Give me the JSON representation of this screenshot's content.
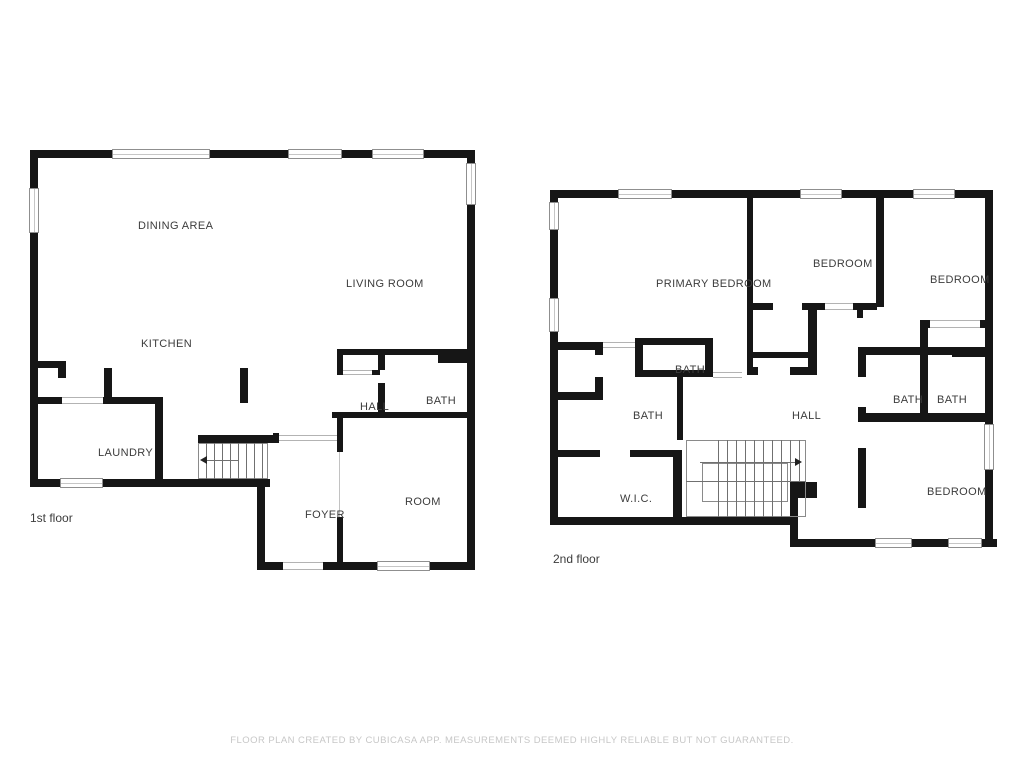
{
  "title": "Floor plan",
  "colors": {
    "wall": "#161616",
    "label": "#3c3c3c",
    "footer": "#c7c7c7",
    "window_border": "#8f8f8f"
  },
  "footer": {
    "text": "FLOOR PLAN CREATED BY CUBICASA APP. MEASUREMENTS DEEMED HIGHLY RELIABLE BUT NOT GUARANTEED."
  },
  "floors": [
    {
      "label": "1st floor",
      "label_pos": [
        30,
        511
      ],
      "rooms": [
        {
          "name": "DINING AREA",
          "x": 138,
          "y": 220
        },
        {
          "name": "LIVING ROOM",
          "x": 346,
          "y": 278
        },
        {
          "name": "KITCHEN",
          "x": 141,
          "y": 338
        },
        {
          "name": "HALL",
          "x": 360,
          "y": 401
        },
        {
          "name": "BATH",
          "x": 426,
          "y": 395
        },
        {
          "name": "LAUNDRY",
          "x": 98,
          "y": 447
        },
        {
          "name": "FOYER",
          "x": 305,
          "y": 509
        },
        {
          "name": "ROOM",
          "x": 405,
          "y": 496
        }
      ],
      "walls": [
        [
          30,
          150,
          445,
          8
        ],
        [
          30,
          150,
          8,
          337
        ],
        [
          467,
          150,
          8,
          420
        ],
        [
          30,
          479,
          240,
          8
        ],
        [
          257,
          479,
          8,
          91
        ],
        [
          257,
          562,
          28,
          8
        ],
        [
          321,
          562,
          154,
          8
        ],
        [
          30,
          397,
          133,
          7
        ],
        [
          155,
          397,
          8,
          90
        ],
        [
          30,
          361,
          36,
          7
        ],
        [
          58,
          361,
          8,
          17
        ],
        [
          104,
          368,
          8,
          36
        ],
        [
          240,
          368,
          8,
          35
        ],
        [
          198,
          435,
          77,
          8
        ],
        [
          273,
          433,
          6,
          10
        ],
        [
          337,
          349,
          138,
          6
        ],
        [
          438,
          353,
          37,
          10
        ],
        [
          337,
          349,
          6,
          26
        ],
        [
          372,
          370,
          8,
          5
        ],
        [
          378,
          349,
          7,
          21
        ],
        [
          378,
          383,
          7,
          29
        ],
        [
          332,
          412,
          141,
          6
        ],
        [
          337,
          412,
          6,
          40
        ],
        [
          337,
          517,
          6,
          45
        ]
      ],
      "windows": [
        [
          112,
          149,
          98,
          10
        ],
        [
          288,
          149,
          54,
          10
        ],
        [
          372,
          149,
          52,
          10
        ],
        [
          29,
          188,
          10,
          45
        ],
        [
          466,
          163,
          10,
          42
        ],
        [
          60,
          478,
          43,
          10
        ],
        [
          377,
          561,
          53,
          10
        ]
      ],
      "openings": [
        [
          62,
          397,
          41,
          7
        ],
        [
          343,
          370,
          29,
          5
        ],
        [
          279,
          435,
          58,
          6
        ],
        [
          283,
          562,
          40,
          8
        ]
      ],
      "lines": [
        [
          339,
          452,
          339,
          517
        ]
      ],
      "stairs": {
        "rects": [
          [
            198,
            443,
            70,
            36
          ]
        ],
        "lines": [
          [
            206,
            443,
            206,
            479
          ],
          [
            214,
            443,
            214,
            479
          ],
          [
            222,
            443,
            222,
            479
          ],
          [
            230,
            443,
            230,
            479
          ],
          [
            238,
            443,
            238,
            479
          ],
          [
            246,
            443,
            246,
            479
          ],
          [
            254,
            443,
            254,
            479
          ],
          [
            262,
            443,
            262,
            479
          ]
        ],
        "arrow": {
          "tail": [
            238,
            460
          ],
          "tip": [
            201,
            460
          ]
        }
      }
    },
    {
      "label": "2nd floor",
      "label_pos": [
        553,
        552
      ],
      "rooms": [
        {
          "name": "PRIMARY BEDROOM",
          "x": 656,
          "y": 278
        },
        {
          "name": "BEDROOM",
          "x": 813,
          "y": 258
        },
        {
          "name": "BEDROOM",
          "x": 930,
          "y": 274
        },
        {
          "name": "BATH",
          "x": 675,
          "y": 364
        },
        {
          "name": "BATH",
          "x": 633,
          "y": 410
        },
        {
          "name": "HALL",
          "x": 792,
          "y": 410
        },
        {
          "name": "BATH",
          "x": 893,
          "y": 394
        },
        {
          "name": "BATH",
          "x": 937,
          "y": 394
        },
        {
          "name": "BEDROOM",
          "x": 927,
          "y": 486
        },
        {
          "name": "W.I.C.",
          "x": 620,
          "y": 493
        }
      ],
      "walls": [
        [
          550,
          190,
          443,
          8
        ],
        [
          550,
          190,
          8,
          335
        ],
        [
          985,
          190,
          8,
          357
        ],
        [
          550,
          517,
          248,
          8
        ],
        [
          790,
          539,
          207,
          8
        ],
        [
          790,
          482,
          8,
          65
        ],
        [
          790,
          482,
          27,
          16
        ],
        [
          747,
          192,
          6,
          181
        ],
        [
          876,
          192,
          8,
          115
        ],
        [
          753,
          303,
          20,
          7
        ],
        [
          802,
          303,
          23,
          7
        ],
        [
          853,
          303,
          24,
          7
        ],
        [
          857,
          310,
          6,
          8
        ],
        [
          747,
          352,
          68,
          6
        ],
        [
          747,
          367,
          11,
          8
        ],
        [
          790,
          367,
          27,
          8
        ],
        [
          808,
          303,
          9,
          72
        ],
        [
          635,
          338,
          78,
          7
        ],
        [
          635,
          338,
          8,
          39
        ],
        [
          705,
          338,
          8,
          39
        ],
        [
          635,
          370,
          78,
          7
        ],
        [
          558,
          342,
          45,
          8
        ],
        [
          558,
          392,
          45,
          8
        ],
        [
          595,
          342,
          8,
          13
        ],
        [
          595,
          377,
          8,
          16
        ],
        [
          677,
          377,
          6,
          63
        ],
        [
          550,
          450,
          50,
          7
        ],
        [
          630,
          450,
          52,
          7
        ],
        [
          673,
          450,
          9,
          75
        ],
        [
          920,
          320,
          65,
          8
        ],
        [
          920,
          320,
          8,
          35
        ],
        [
          858,
          347,
          135,
          8
        ],
        [
          952,
          347,
          41,
          10
        ],
        [
          858,
          347,
          8,
          30
        ],
        [
          858,
          407,
          8,
          15
        ],
        [
          920,
          355,
          8,
          58
        ],
        [
          858,
          413,
          135,
          9
        ],
        [
          858,
          448,
          8,
          60
        ]
      ],
      "windows": [
        [
          618,
          189,
          54,
          10
        ],
        [
          800,
          189,
          42,
          10
        ],
        [
          913,
          189,
          42,
          10
        ],
        [
          549,
          202,
          10,
          28
        ],
        [
          549,
          298,
          10,
          34
        ],
        [
          984,
          424,
          10,
          46
        ],
        [
          875,
          538,
          37,
          10
        ],
        [
          948,
          538,
          34,
          10
        ]
      ],
      "openings": [
        [
          603,
          342,
          32,
          6
        ],
        [
          713,
          372,
          29,
          6
        ],
        [
          825,
          303,
          28,
          7
        ],
        [
          930,
          320,
          50,
          8
        ]
      ],
      "lines": [],
      "stairs": {
        "rects": [
          [
            686,
            440,
            120,
            77
          ],
          [
            702,
            463,
            86,
            39
          ]
        ],
        "lines": [
          [
            686,
            481,
            806,
            481
          ],
          [
            718,
            440,
            718,
            481
          ],
          [
            727,
            440,
            727,
            481
          ],
          [
            736,
            440,
            736,
            481
          ],
          [
            745,
            440,
            745,
            481
          ],
          [
            754,
            440,
            754,
            481
          ],
          [
            763,
            440,
            763,
            481
          ],
          [
            772,
            440,
            772,
            481
          ],
          [
            781,
            440,
            781,
            481
          ],
          [
            790,
            440,
            790,
            481
          ],
          [
            799,
            440,
            799,
            481
          ],
          [
            718,
            481,
            718,
            517
          ],
          [
            727,
            481,
            727,
            517
          ],
          [
            736,
            481,
            736,
            517
          ],
          [
            745,
            481,
            745,
            517
          ],
          [
            754,
            481,
            754,
            517
          ],
          [
            763,
            481,
            763,
            517
          ],
          [
            772,
            481,
            772,
            517
          ],
          [
            781,
            481,
            781,
            517
          ]
        ],
        "arrow": {
          "tail": [
            700,
            462
          ],
          "tip": [
            801,
            462
          ]
        }
      }
    }
  ]
}
